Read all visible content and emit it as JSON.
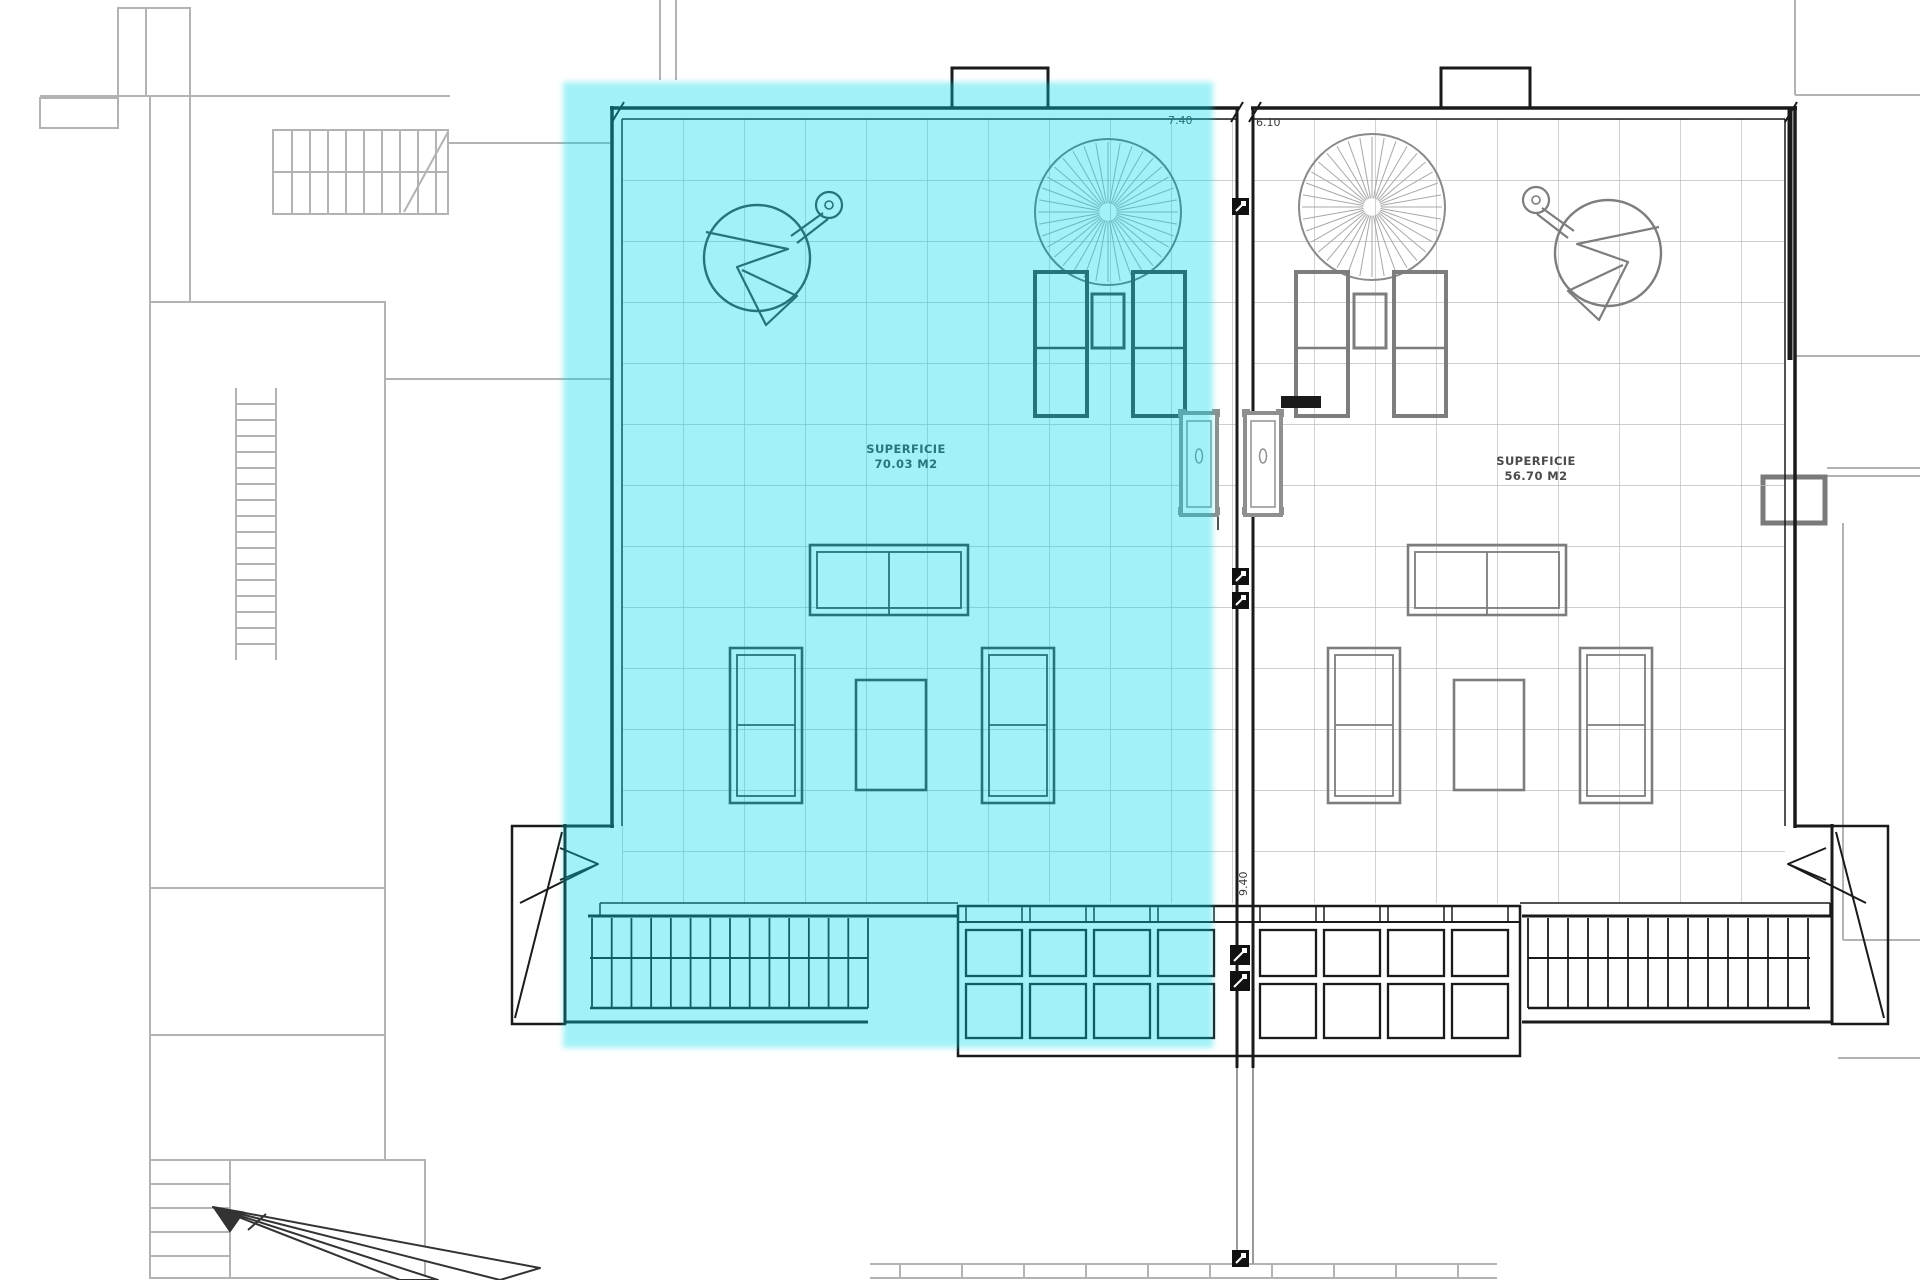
{
  "plan": {
    "type": "architectural-roof-terrace-plan",
    "units": [
      {
        "id": "left",
        "superficie_label": "SUPERFICIE",
        "area": "70.03 M2",
        "highlighted": true
      },
      {
        "id": "right",
        "superficie_label": "SUPERFICIE",
        "area": "56.70 M2",
        "highlighted": false
      }
    ],
    "dimensions": {
      "top_left_width": "7.40",
      "top_right_width": "6.10",
      "right_side_depth": "9.40"
    },
    "colors": {
      "highlight_cyan": "rgba(0,216,235,0.36)",
      "wall": "#1a1a1a",
      "context_gray": "#b3b3b3",
      "furniture_left": "#3c3c3c",
      "furniture_right": "#7d7d7d",
      "door_gray": "#8f8f8f",
      "grid_gray": "#bdbdbd"
    }
  }
}
